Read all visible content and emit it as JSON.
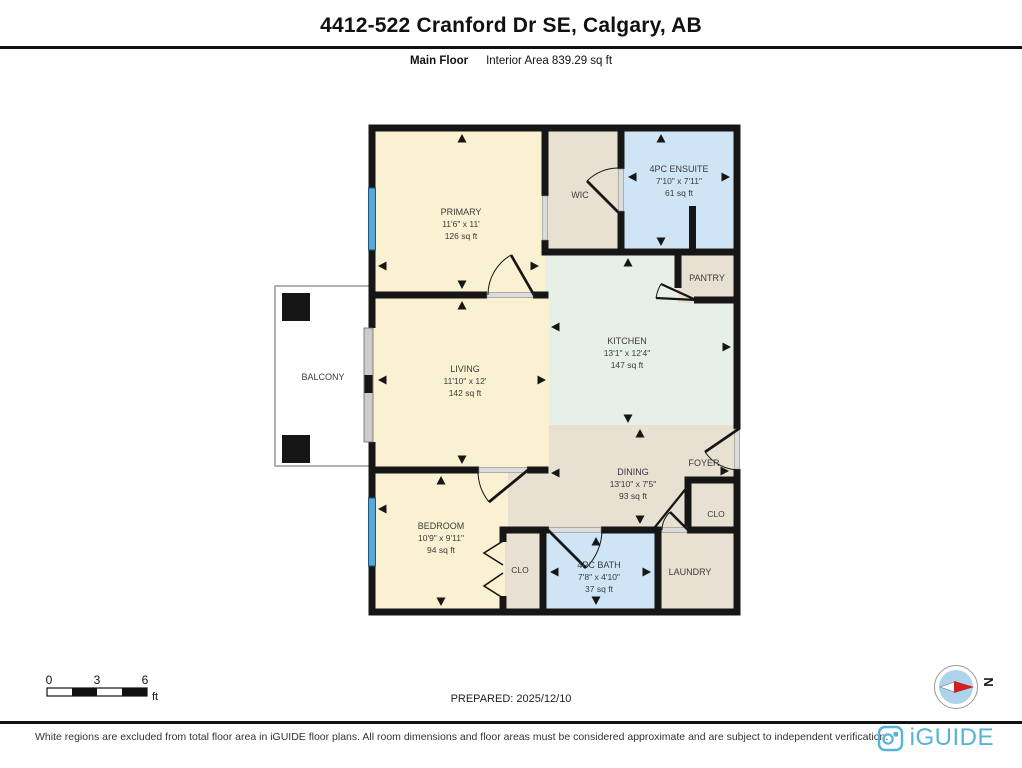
{
  "header": {
    "title": "4412-522 Cranford Dr SE, Calgary, AB",
    "floor_label": "Main Floor",
    "area_label": "Interior Area 839.29 sq ft"
  },
  "rooms": {
    "primary": {
      "name": "PRIMARY",
      "dims": "11'6\" x 11'",
      "area": "126 sq ft"
    },
    "wic": {
      "name": "WIC"
    },
    "ensuite": {
      "name": "4PC ENSUITE",
      "dims": "7'10\" x 7'11\"",
      "area": "61 sq ft"
    },
    "pantry": {
      "name": "PANTRY"
    },
    "kitchen": {
      "name": "KITCHEN",
      "dims": "13'1\" x 12'4\"",
      "area": "147 sq ft"
    },
    "living": {
      "name": "LIVING",
      "dims": "11'10\" x 12'",
      "area": "142 sq ft"
    },
    "balcony": {
      "name": "BALCONY"
    },
    "dining": {
      "name": "DINING",
      "dims": "13'10\" x 7'5\"",
      "area": "93 sq ft"
    },
    "foyer": {
      "name": "FOYER"
    },
    "foyer_closet": {
      "name": "CLO"
    },
    "bedroom": {
      "name": "BEDROOM",
      "dims": "10'9\" x 9'11\"",
      "area": "94 sq ft"
    },
    "bedroom_closet": {
      "name": "CLO"
    },
    "bath": {
      "name": "4PC BATH",
      "dims": "7'8\" x 4'10\"",
      "area": "37 sq ft"
    },
    "laundry": {
      "name": "LAUNDRY"
    }
  },
  "scale_bar": {
    "tick0": "0",
    "tick1": "3",
    "tick2": "6",
    "unit": "ft"
  },
  "prepared": "PREPARED: 2025/12/10",
  "compass": {
    "label": "N"
  },
  "footer": {
    "disclaimer": "White regions are excluded from total floor area in iGUIDE floor plans. All room dimensions and floor areas must be considered approximate and are subject to independent verification.",
    "brand": "iGUIDE"
  },
  "colors": {
    "wall": "#161616",
    "room_cream": "#faf0d2",
    "room_beige": "#e8e0d1",
    "room_blue": "#cfe5f5",
    "room_green": "#e7f0e7",
    "window_blue": "#5aa7d9",
    "brand_blue": "#57b3d7",
    "compass_red": "#cc2222"
  }
}
